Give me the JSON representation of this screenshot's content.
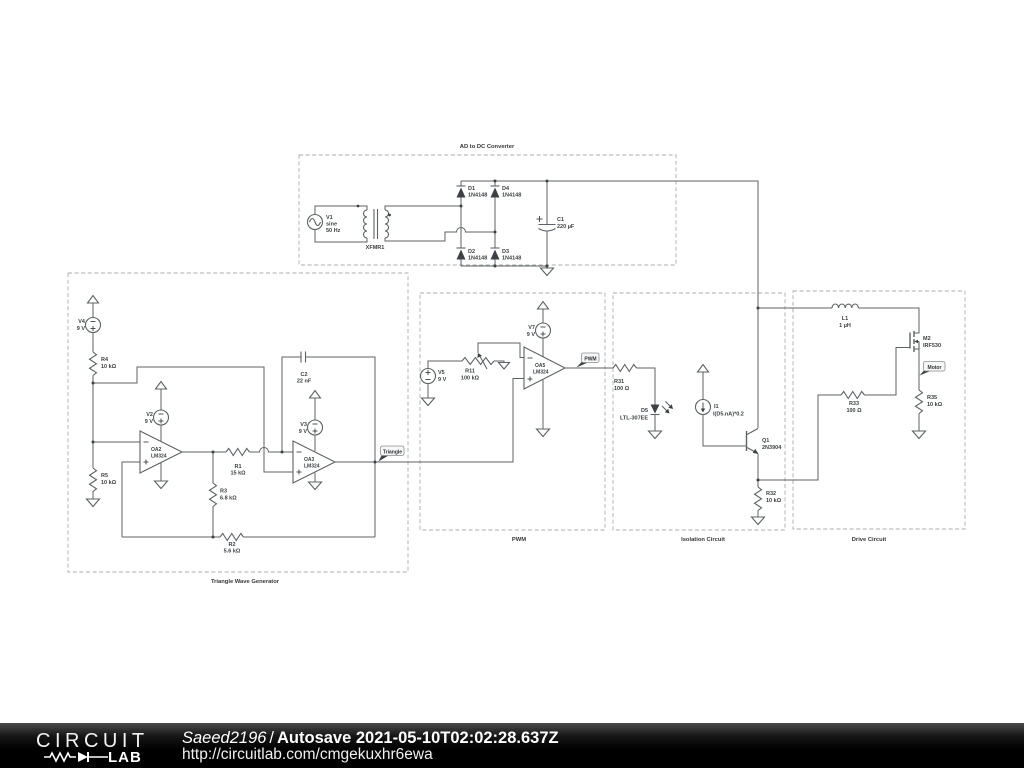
{
  "footer": {
    "brand_top": "CIRCUIT",
    "brand_bottom": "LAB",
    "user": "Saeed2196",
    "separator": "/",
    "autosave": "Autosave 2021-05-10T02:02:28.637Z",
    "url": "http://circuitlab.com/cmgekuxhr6ewa"
  },
  "sections": {
    "ad_dc": {
      "title": "AD to DC Converter"
    },
    "triangle_gen": {
      "title": "Triangle Wave Generator"
    },
    "pwm": {
      "title": "PWM"
    },
    "isolation": {
      "title": "Isolation Circuit"
    },
    "drive": {
      "title": "Drive Circuit"
    }
  },
  "flags": {
    "triangle": "Triangle",
    "pwm": "PWM",
    "motor": "Motor"
  },
  "components": {
    "v1": {
      "name": "V1",
      "type": "sine",
      "value": "50 Hz"
    },
    "xfmr1": {
      "name": "XFMR1"
    },
    "d1": {
      "name": "D1",
      "value": "1N4148"
    },
    "d2": {
      "name": "D2",
      "value": "1N4148"
    },
    "d3": {
      "name": "D3",
      "value": "1N4148"
    },
    "d4": {
      "name": "D4",
      "value": "1N4148"
    },
    "c1": {
      "name": "C1",
      "value": "220 µF"
    },
    "v2": {
      "name": "V2",
      "value": "9 V"
    },
    "v3": {
      "name": "V3",
      "value": "9 V"
    },
    "v4": {
      "name": "V4",
      "value": "9 V"
    },
    "v5": {
      "name": "V5",
      "value": "9 V"
    },
    "v7": {
      "name": "V7",
      "value": "9 V"
    },
    "r1": {
      "name": "R1",
      "value": "15 kΩ"
    },
    "r2": {
      "name": "R2",
      "value": "5.6 kΩ"
    },
    "r3": {
      "name": "R3",
      "value": "6.8 kΩ"
    },
    "r4": {
      "name": "R4",
      "value": "10 kΩ"
    },
    "r5": {
      "name": "R5",
      "value": "10 kΩ"
    },
    "r11": {
      "name": "R11",
      "value": "100 kΩ"
    },
    "c2": {
      "name": "C2",
      "value": "22 nF"
    },
    "oa2": {
      "name": "OA2",
      "value": "LM324"
    },
    "oa3": {
      "name": "OA3",
      "value": "LM324"
    },
    "oa5": {
      "name": "OA5",
      "value": "LM324"
    },
    "r31": {
      "name": "R31",
      "value": "100 Ω"
    },
    "d5": {
      "name": "D5",
      "value": "LTL-307EE"
    },
    "i1": {
      "name": "I1",
      "value": "I(D5.nA)*0.2"
    },
    "q1": {
      "name": "Q1",
      "value": "2N3904"
    },
    "r32": {
      "name": "R32",
      "value": "10 kΩ"
    },
    "l1": {
      "name": "L1",
      "value": "1 µH"
    },
    "m2": {
      "name": "M2",
      "value": "IRF530"
    },
    "r33": {
      "name": "R33",
      "value": "100 Ω"
    },
    "r35": {
      "name": "R35",
      "value": "10 kΩ"
    }
  },
  "colors": {
    "wire": "#5d6266",
    "text": "#3a3e41",
    "box_border": "#a8acae",
    "footer_bg": "#000000",
    "footer_text": "#ffffff"
  }
}
